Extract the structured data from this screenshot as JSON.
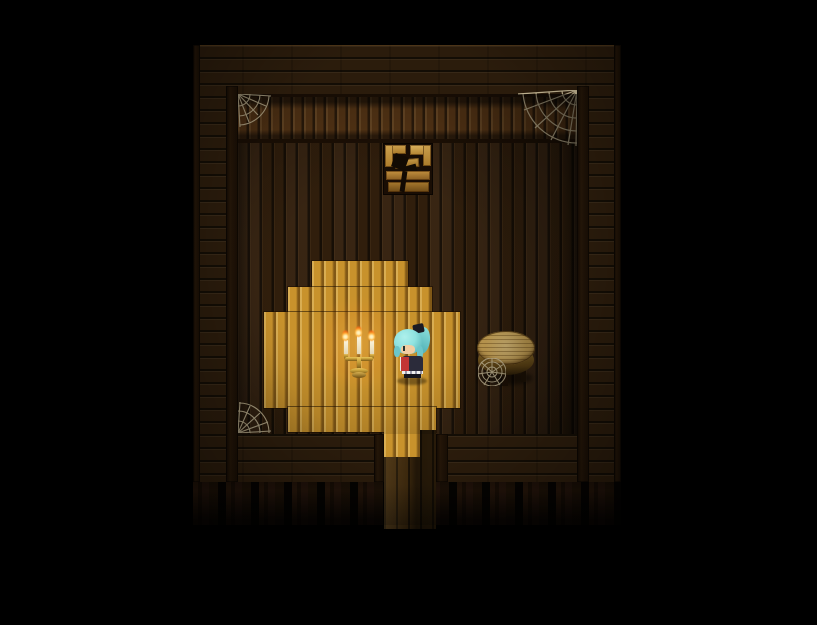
{
  "meta": {
    "scene_label": "top-down RPG game scene: dark wooden cabin interior at night",
    "visible_text": "none"
  },
  "colors": {
    "bg": "#000000",
    "outer-wood": "#2b1c0c",
    "beam": "#241608",
    "wall-band": "#573616",
    "floor": "#33200d",
    "platform": "#c8922c",
    "post-gap": "#070402",
    "web": "#d9cba6",
    "gold": "#c9a23a",
    "flame": "#ffb239",
    "flame-core": "#fff3c0",
    "hair": "#8fe2df",
    "bow": "#1b1b24",
    "skin": "#f2cda2",
    "outfit": "#2b2b3a",
    "scarf": "#c23535",
    "table-top": "#c9a355",
    "crate-wood": "#d0a045"
  },
  "entities": {
    "player": {
      "name": "player-character",
      "description": "girl sprite with cyan ponytail hair, black hair bow, dark dress with red scarf, facing left",
      "facing": "left"
    },
    "candelabra": {
      "name": "lit-candelabra",
      "candles": 3,
      "lit": true
    },
    "crate": {
      "name": "broken-crate",
      "state": "broken wooden crate against north wall"
    },
    "table": {
      "name": "round-wooden-table",
      "shape": "round",
      "cobweb_on_legs": true
    },
    "webs": {
      "count": 4,
      "positions": [
        "wall-top-left",
        "wall-top-right",
        "floor-bottom-left",
        "table-legs"
      ]
    },
    "platform": {
      "name": "light-wood-platform",
      "shape": "stepped octagon"
    },
    "path": {
      "name": "south-exit-path",
      "direction": "south",
      "partially_lit": true
    },
    "room": {
      "walls": "dark horizontal planks",
      "floor": "dark vertical planks",
      "under_floor": "fence posts"
    }
  }
}
